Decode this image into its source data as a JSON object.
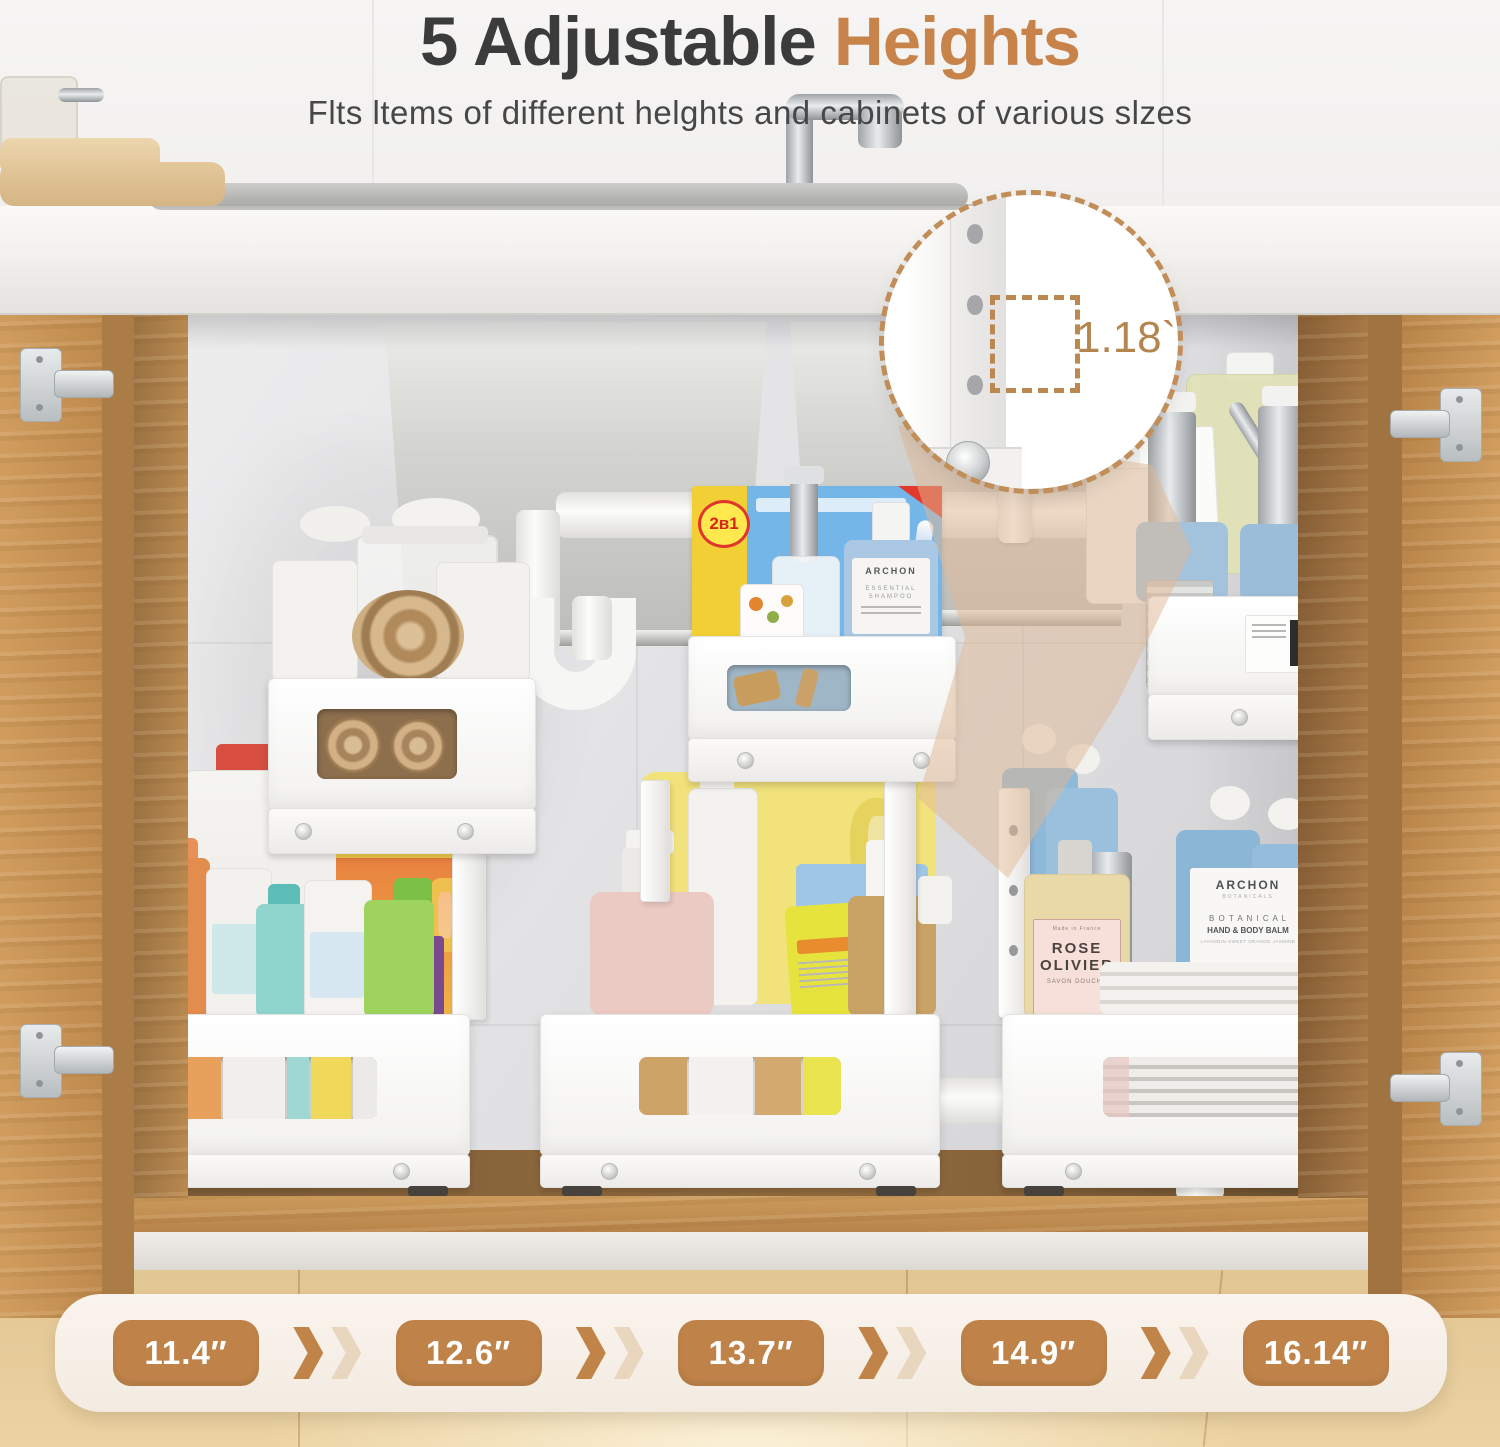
{
  "header": {
    "title": "5 Adjustable",
    "title_accent": "Heights",
    "subtitle": "Flts ltems of different helghts and cabinets of various slzes"
  },
  "callout": {
    "measurement": "1.18`"
  },
  "heights": {
    "values": [
      "11.4″",
      "12.6″",
      "13.7″",
      "14.9″",
      "16.14″"
    ]
  },
  "products": {
    "box_badge": "2в1",
    "shampoo": {
      "brand": "ARCHON",
      "line1": "ESSENTIAL",
      "line2": "SHAMPOO"
    },
    "rose": {
      "origin": "Made in France",
      "name1": "ROSE",
      "name2": "OLIVIER",
      "type": "SAVON DOUCHE"
    },
    "balm": {
      "brand": "ARCHON",
      "sub": "BOTANICALS",
      "line1": "B O T A N I C A L",
      "line2": "HAND & BODY BALM",
      "line3": "LAVANDIN SWEET ORANGE JASMINE"
    }
  },
  "colors": {
    "accent": "#bf8349",
    "title_accent": "#c8834b",
    "beam": "#dfb894",
    "bar_bg": "#f8f1e9",
    "pill_bg": "#bf8349",
    "wood": "#c79455",
    "callout_border": "#c18d58"
  }
}
